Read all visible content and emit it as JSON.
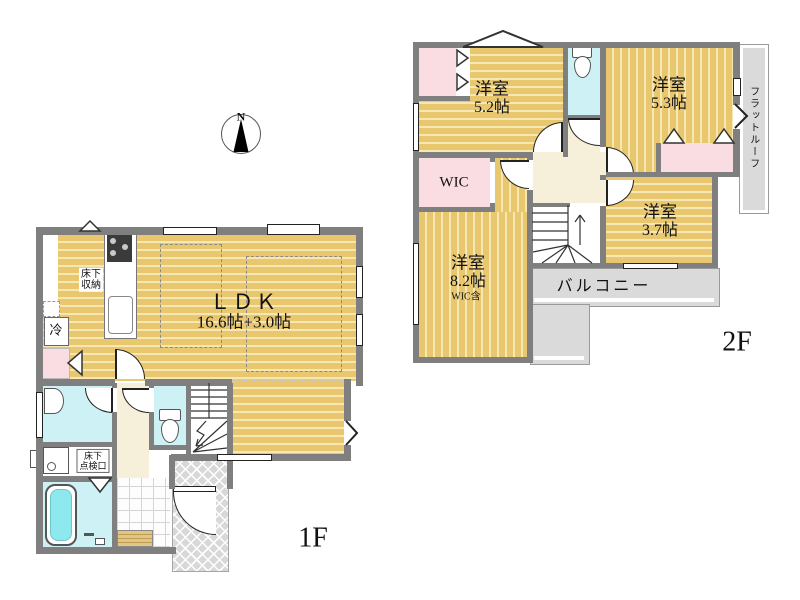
{
  "compass": {
    "north_label": "N"
  },
  "floor1": {
    "floor_label": "1F",
    "ldk_line1": "ＬＤＫ",
    "ldk_line2": "16.6帖+3.0帖",
    "underfloor_storage_line1": "床下",
    "underfloor_storage_line2": "収納",
    "fridge_label": "冷",
    "underfloor_inspection_line1": "床下",
    "underfloor_inspection_line2": "点検口"
  },
  "floor2": {
    "floor_label": "2F",
    "room_5_2_name": "洋室",
    "room_5_2_size": "5.2帖",
    "room_5_3_name": "洋室",
    "room_5_3_size": "5.3帖",
    "room_3_7_name": "洋室",
    "room_3_7_size": "3.7帖",
    "room_8_2_name": "洋室",
    "room_8_2_size": "8.2帖",
    "room_8_2_note": "WIC含",
    "wic_label": "WIC",
    "balcony_label": "バルコニー",
    "flat_roof_label": "フラットルーフ"
  },
  "colors": {
    "wood_floor": "#e9c76e",
    "wood_stripe": "#f7e7b2",
    "wet_area_cyan": "#cdf1f5",
    "bathtub_water": "#8ee9ef",
    "closet_pink": "#fadde3",
    "hall_cream": "#f6efd9",
    "outdoor_gray": "#dadada",
    "wall_gray": "#7f7f7f"
  }
}
